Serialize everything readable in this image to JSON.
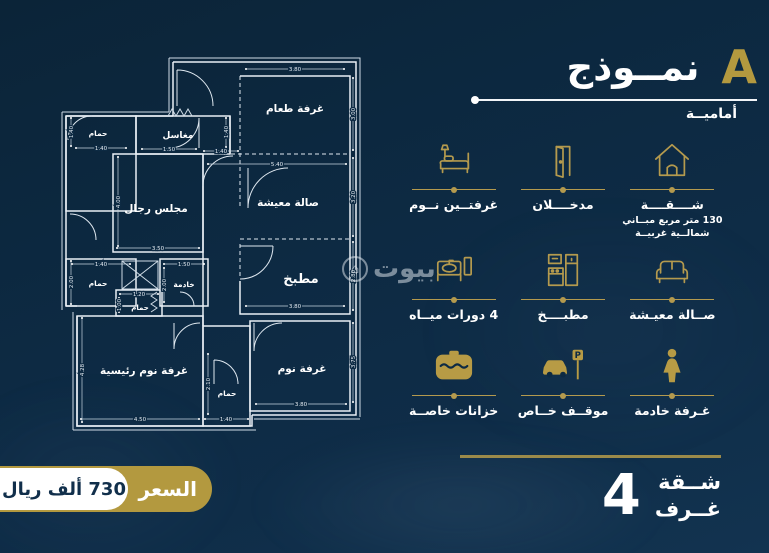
{
  "header": {
    "title": "نمــوذج",
    "model_letter": "A",
    "subtitle": "أماميــة"
  },
  "watermark": {
    "text": "بيوت"
  },
  "features": [
    {
      "icon": "house-icon",
      "lines": [
        "شــــقــــة",
        "130 متر مربع مبــاني",
        "شمالــية غربيــة"
      ]
    },
    {
      "icon": "door-icon",
      "lines": [
        "مدخــــلان"
      ]
    },
    {
      "icon": "bed-icon",
      "lines": [
        "غرفتــين نــوم"
      ]
    },
    {
      "icon": "sofa-icon",
      "lines": [
        "صــالة معيـشة"
      ]
    },
    {
      "icon": "kitchen-icon",
      "lines": [
        "مطبــــخ"
      ]
    },
    {
      "icon": "bathroom-icon",
      "lines": [
        "4 دورات ميــاه"
      ]
    },
    {
      "icon": "maid-icon",
      "lines": [
        "غـرفة خادمة"
      ]
    },
    {
      "icon": "parking-icon",
      "lines": [
        "موقــف خــاص"
      ]
    },
    {
      "icon": "tank-icon",
      "lines": [
        "خزانات خاصــة"
      ]
    }
  ],
  "summary": {
    "apartment_word": "شــقة",
    "rooms_word": "غــرف",
    "rooms_count": "4"
  },
  "price": {
    "label": "السعر",
    "value": "730 ألف ريال"
  },
  "colors": {
    "background": "#0d2a43",
    "gold": "#b49a4e",
    "white": "#ffffff",
    "navy_text": "#112f4b"
  },
  "floorplan": {
    "rooms": {
      "dining": "غرفة طعام",
      "living": "صالة معيشة",
      "kitchen": "مطبخ",
      "bedroom": "غرفة نوم",
      "master": "غرفة نوم رئيسية",
      "majlis": "مجلس رجال",
      "sinks": "مغاسل",
      "bath_top": "حمام",
      "bath_mid": "حمام",
      "bath_small": "حمام",
      "maid": "خادمة",
      "bath_bottom": "حمام"
    },
    "dims": {
      "dining_w": "3.80",
      "dining_h": "3.00",
      "living_w": "5.40",
      "living_h": "3.20",
      "hall_gap": "1.40",
      "kitchen_w": "3.80",
      "kitchen_h": "2.80",
      "bedroom_w": "3.80",
      "bedroom_h": "3.75",
      "master_w": "4.50",
      "master_h": "4.28",
      "majlis_w": "3.50",
      "majlis_h": "4.00",
      "sinks_w": "1.50",
      "sinks_h": "1.40",
      "bath_top_w": "1.40",
      "bath_top_h": "1.40",
      "bath_mid_w": "1.40",
      "bath_mid_h": "2.00",
      "maid_w": "1.50",
      "maid_h": "2.00",
      "bath_small_w": "1.20",
      "bath_small_h": "1.00",
      "bath_bottom_w": "1.40",
      "bath_bottom_h": "2.10"
    }
  }
}
